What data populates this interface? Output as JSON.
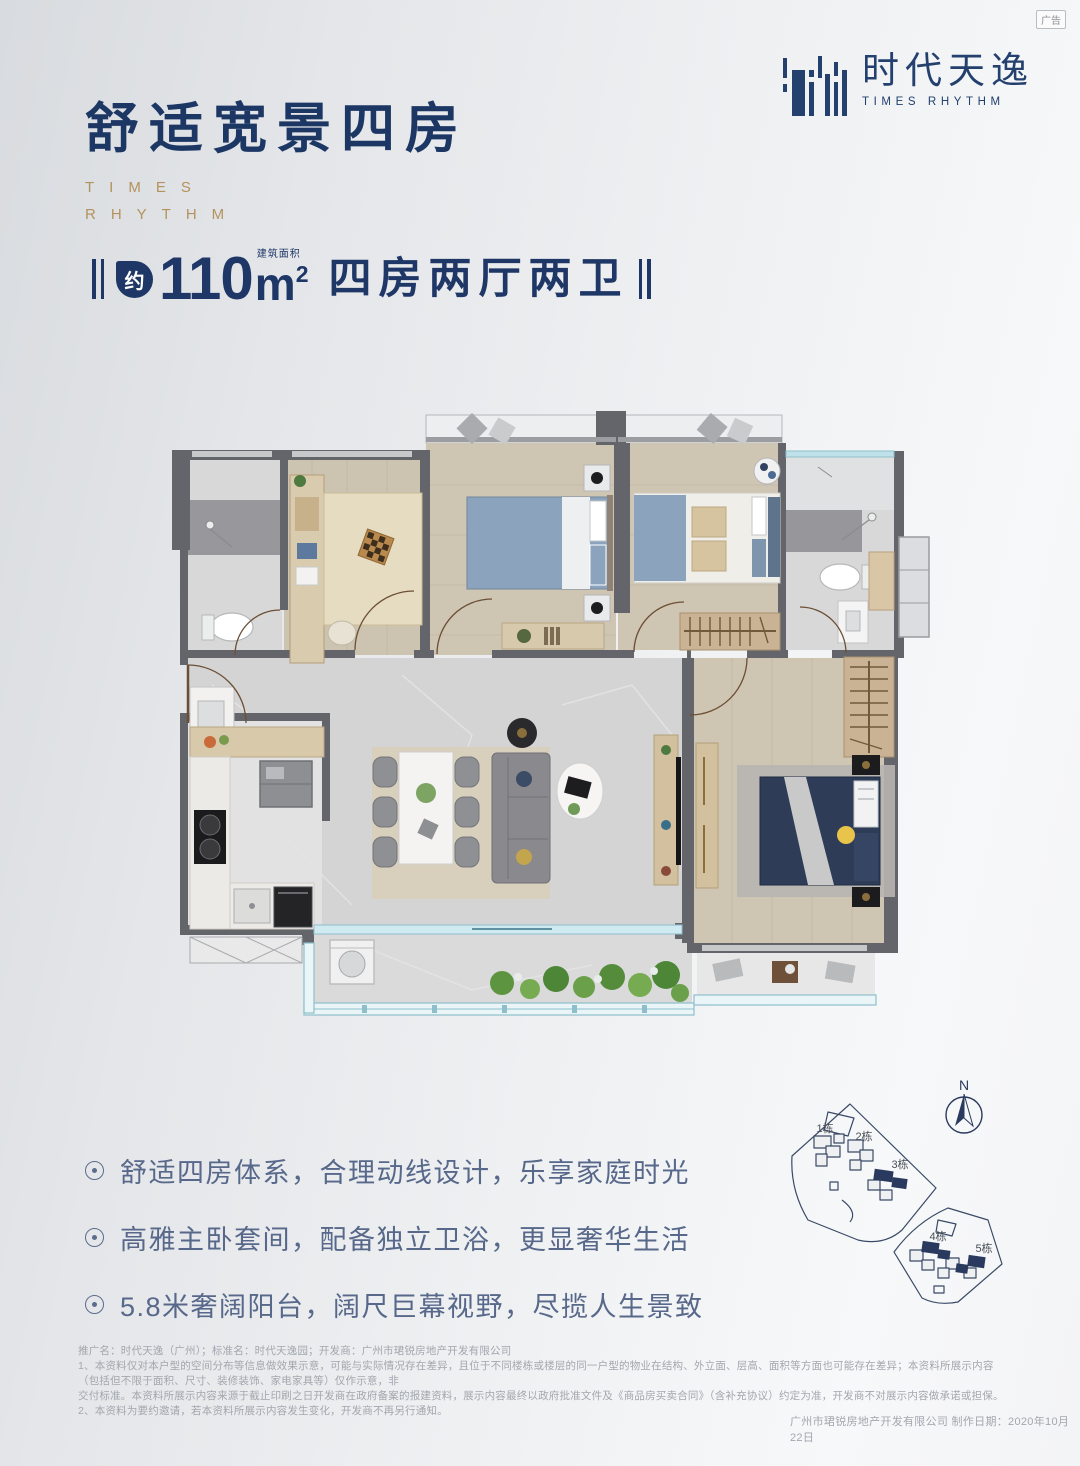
{
  "page": {
    "ad_label": "广告"
  },
  "brand_colors": {
    "navy": "#1e3766",
    "gold": "#b5925d",
    "feature_blue": "#57688a",
    "highlight_building": "#2a3a5e"
  },
  "logo": {
    "cn": "时代天逸",
    "en": "TIMES RHYTHM"
  },
  "title": {
    "cn": "舒适宽景四房",
    "en1": "TIMES",
    "en2": "RHYTHM"
  },
  "headline": {
    "approx": "约",
    "area_value": "110",
    "area_unit": "m",
    "area_sup": "2",
    "area_note": "建筑面积",
    "rooms": "四房两厅两卫"
  },
  "features": [
    {
      "text": "舒适四房体系，合理动线设计，乐享家庭时光"
    },
    {
      "text": "高雅主卧套间，配备独立卫浴，更显奢华生活"
    },
    {
      "text": "5.8米奢阔阳台，阔尺巨幕视野，尽揽人生景致"
    }
  ],
  "site_plan": {
    "north": "N",
    "b1": "1栋",
    "b2": "2栋",
    "b3": "3栋",
    "b4": "4栋",
    "b5": "5栋"
  },
  "disclaimer": {
    "line1": "推广名：时代天逸（广州）；标准名：时代天逸园；开发商：广州市珺锐房地产开发有限公司",
    "line2": "1、本资料仅对本户型的空间分布等信息做效果示意，可能与实际情况存在差异，且位于不同楼栋或楼层的同一户型的物业在结构、外立面、层高、面积等方面也可能存在差异；本资料所展示内容（包括但不限于面积、尺寸、装修装饰、家电家具等）仅作示意，非",
    "line3": "交付标准。本资料所展示内容来源于截止印刷之日开发商在政府备案的报建资料，展示内容最终以政府批准文件及《商品房买卖合同》（含补充协议）约定为准，开发商不对展示内容做承诺或担保。",
    "line4": "2、本资料为要约邀请，若本资料所展示内容发生变化，开发商不再另行通知。"
  },
  "credit": "广州市珺锐房地产开发有限公司 制作日期：2020年10月22日"
}
